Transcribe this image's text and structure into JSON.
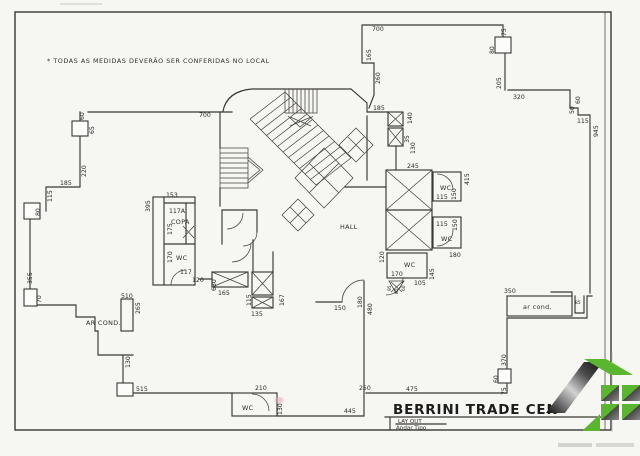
{
  "note": "* TODAS AS MEDIDAS DEVERÃO SER CONFERIDAS NO LOCAL",
  "title": {
    "name": "BERRINI TRADE CEN",
    "subtitle": "LAY OUT",
    "subtitle2": "Andar Tipo"
  },
  "colors": {
    "logo_green": "#5ab62e",
    "ink": "#3a3833",
    "paper": "#f6f6f3"
  },
  "labels": [
    {
      "t": "700",
      "x": 199,
      "y": 117
    },
    {
      "t": "60",
      "x": 84,
      "y": 120,
      "r": 1
    },
    {
      "t": "65",
      "x": 94,
      "y": 134,
      "r": 1
    },
    {
      "t": "220",
      "x": 86,
      "y": 177,
      "r": 1
    },
    {
      "t": "185",
      "x": 60,
      "y": 185
    },
    {
      "t": "115",
      "x": 52,
      "y": 202,
      "r": 1
    },
    {
      "t": "80",
      "x": 40,
      "y": 216,
      "r": 1
    },
    {
      "t": "355",
      "x": 32,
      "y": 284,
      "r": 1
    },
    {
      "t": "70",
      "x": 41,
      "y": 303,
      "r": 1
    },
    {
      "t": "700",
      "x": 372,
      "y": 31
    },
    {
      "t": "165",
      "x": 371,
      "y": 61,
      "r": 1
    },
    {
      "t": "260",
      "x": 380,
      "y": 84,
      "r": 1
    },
    {
      "t": "75",
      "x": 506,
      "y": 36,
      "r": 1
    },
    {
      "t": "80",
      "x": 494,
      "y": 54,
      "r": 1
    },
    {
      "t": "205",
      "x": 501,
      "y": 89,
      "r": 1
    },
    {
      "t": "320",
      "x": 513,
      "y": 99
    },
    {
      "t": "60",
      "x": 580,
      "y": 104,
      "r": 1
    },
    {
      "t": "50",
      "x": 574,
      "y": 114,
      "r": 1
    },
    {
      "t": "115",
      "x": 577,
      "y": 123
    },
    {
      "t": "945",
      "x": 598,
      "y": 137,
      "r": 1
    },
    {
      "t": "185",
      "x": 373,
      "y": 110
    },
    {
      "t": "140",
      "x": 412,
      "y": 124,
      "r": 1
    },
    {
      "t": "35",
      "x": 409,
      "y": 143,
      "r": 1
    },
    {
      "t": "130",
      "x": 415,
      "y": 154,
      "r": 1
    },
    {
      "t": "245",
      "x": 407,
      "y": 168
    },
    {
      "t": "415",
      "x": 469,
      "y": 185,
      "r": 1
    },
    {
      "t": "WC",
      "n": "room-label-wc",
      "x": 440,
      "y": 190,
      "cls": "room"
    },
    {
      "t": "115",
      "x": 436,
      "y": 199
    },
    {
      "t": "150",
      "x": 456,
      "y": 200,
      "r": 1
    },
    {
      "t": "115",
      "x": 436,
      "y": 226
    },
    {
      "t": "150",
      "x": 457,
      "y": 231,
      "r": 1
    },
    {
      "t": "WC",
      "n": "room-label-wc",
      "x": 441,
      "y": 241,
      "cls": "room"
    },
    {
      "t": "180",
      "x": 449,
      "y": 257
    },
    {
      "t": "HALL",
      "n": "room-label-hall",
      "x": 340,
      "y": 229,
      "cls": "room"
    },
    {
      "t": "120",
      "x": 384,
      "y": 263,
      "r": 1
    },
    {
      "t": "WC",
      "n": "room-label-wc",
      "x": 404,
      "y": 267,
      "cls": "room"
    },
    {
      "t": "170",
      "x": 391,
      "y": 276
    },
    {
      "t": "105",
      "x": 414,
      "y": 285
    },
    {
      "t": "145",
      "x": 434,
      "y": 280,
      "r": 1
    },
    {
      "t": "95",
      "x": 391,
      "y": 291,
      "r": 1,
      "cls": "tiny"
    },
    {
      "t": "85",
      "x": 398,
      "y": 294,
      "r": 1,
      "cls": "tiny"
    },
    {
      "t": "60",
      "x": 405,
      "y": 291,
      "r": 1,
      "cls": "tiny"
    },
    {
      "t": "120",
      "x": 192,
      "y": 282
    },
    {
      "t": "630",
      "x": 216,
      "y": 291,
      "r": 1
    },
    {
      "t": "165",
      "x": 218,
      "y": 295
    },
    {
      "t": "115",
      "x": 251,
      "y": 306,
      "r": 1
    },
    {
      "t": "135",
      "x": 251,
      "y": 316
    },
    {
      "t": "167",
      "x": 284,
      "y": 306,
      "r": 1
    },
    {
      "t": "150",
      "x": 334,
      "y": 310
    },
    {
      "t": "180",
      "x": 362,
      "y": 308,
      "r": 1
    },
    {
      "t": "480",
      "x": 372,
      "y": 315,
      "r": 1
    },
    {
      "t": "153",
      "x": 166,
      "y": 197
    },
    {
      "t": "395",
      "x": 150,
      "y": 212,
      "r": 1
    },
    {
      "t": "117A",
      "x": 169,
      "y": 213
    },
    {
      "t": "COPA",
      "n": "room-label-copa",
      "x": 171,
      "y": 224,
      "cls": "room"
    },
    {
      "t": "175",
      "x": 172,
      "y": 235,
      "r": 1
    },
    {
      "t": "170",
      "x": 172,
      "y": 263,
      "r": 1
    },
    {
      "t": "WC",
      "n": "room-label-wc",
      "x": 176,
      "y": 260,
      "cls": "room"
    },
    {
      "t": "117",
      "x": 180,
      "y": 274
    },
    {
      "t": "AR COND.",
      "n": "room-label-ar-cond",
      "x": 86,
      "y": 325,
      "cls": "room"
    },
    {
      "t": "510",
      "x": 121,
      "y": 298
    },
    {
      "t": "265",
      "x": 140,
      "y": 314,
      "r": 1
    },
    {
      "t": "130",
      "x": 130,
      "y": 368,
      "r": 1
    },
    {
      "t": "515",
      "x": 136,
      "y": 391
    },
    {
      "t": "210",
      "x": 255,
      "y": 390
    },
    {
      "t": "WC",
      "n": "room-label-wc",
      "x": 242,
      "y": 410,
      "cls": "room"
    },
    {
      "t": "130",
      "x": 282,
      "y": 415,
      "r": 1
    },
    {
      "t": "445",
      "x": 344,
      "y": 413
    },
    {
      "t": "250",
      "x": 359,
      "y": 390
    },
    {
      "t": "475",
      "x": 406,
      "y": 391
    },
    {
      "t": "350",
      "x": 504,
      "y": 293
    },
    {
      "t": "ar cond.",
      "n": "room-label-ar-cond-2",
      "x": 523,
      "y": 309,
      "cls": "room"
    },
    {
      "t": "85",
      "x": 575,
      "y": 304,
      "cls": "tiny"
    },
    {
      "t": "370",
      "x": 506,
      "y": 366,
      "r": 1
    },
    {
      "t": "60",
      "x": 498,
      "y": 383,
      "r": 1
    },
    {
      "t": "75",
      "x": 506,
      "y": 395,
      "r": 1
    }
  ]
}
